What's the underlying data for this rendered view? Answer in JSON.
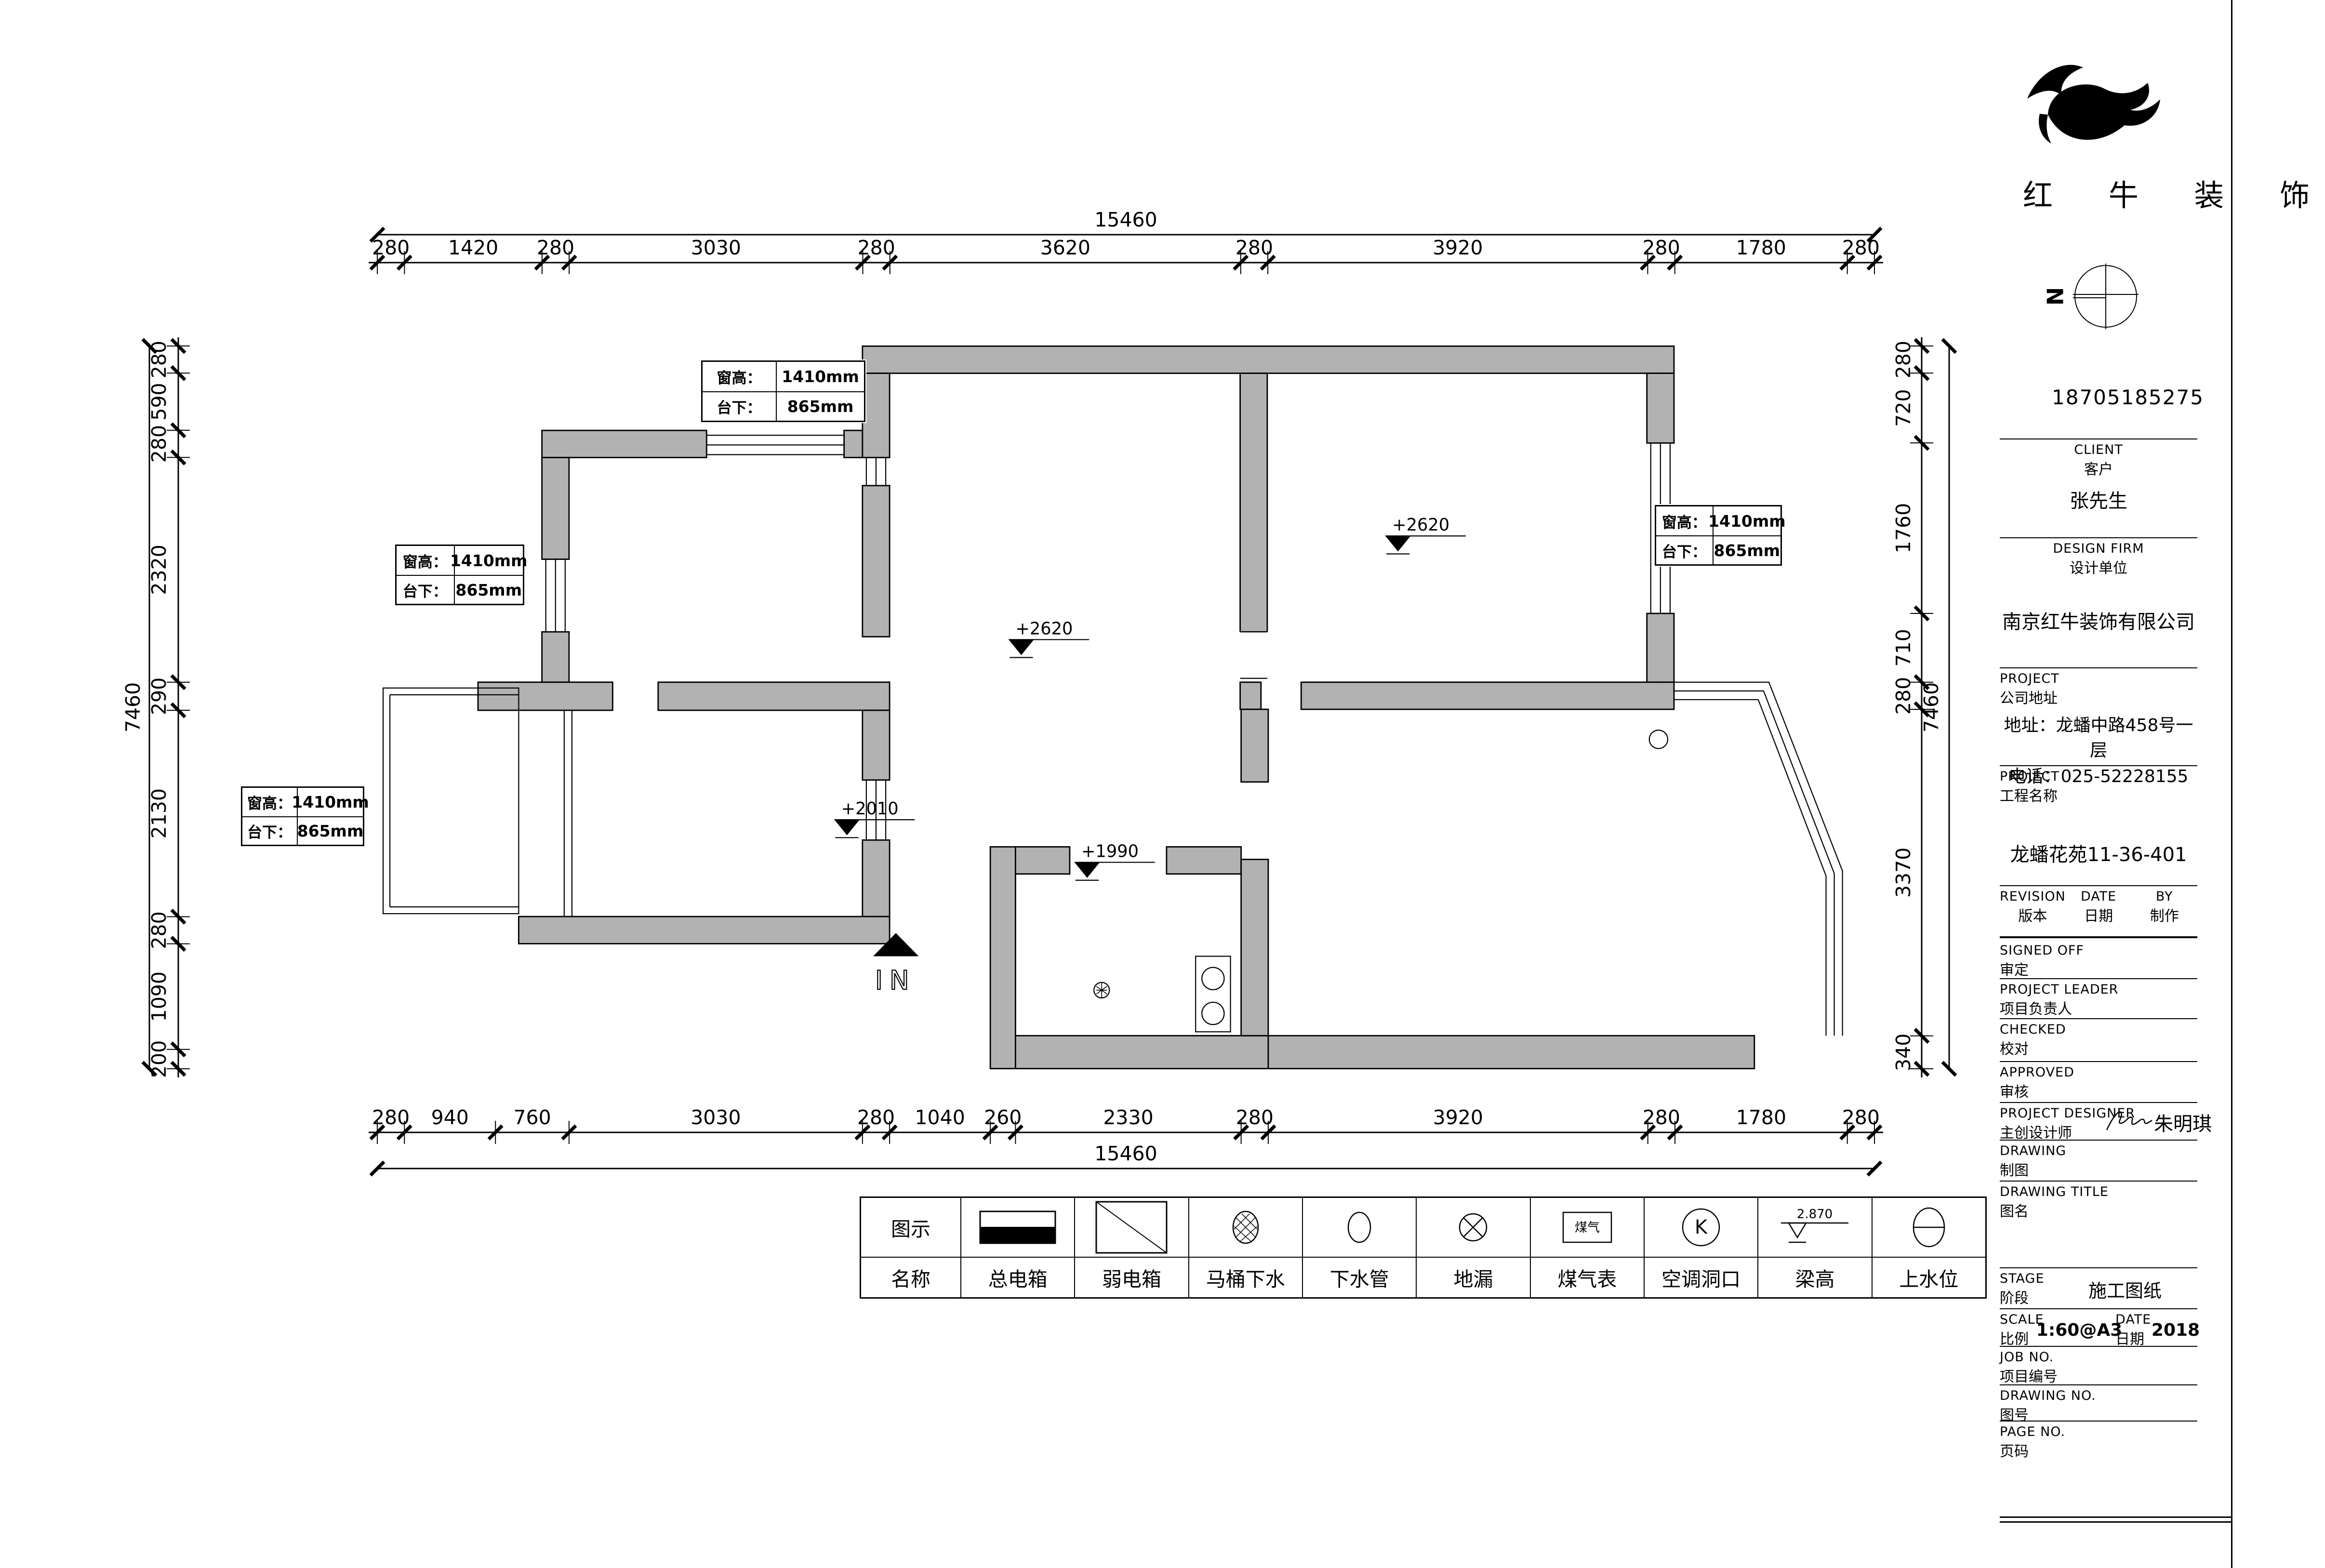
{
  "company": {
    "name": "红 牛 装 饰",
    "phone": "18705185275"
  },
  "north": {
    "label": "N"
  },
  "entry": {
    "label": "IN"
  },
  "colors": {
    "wall_fill": "#b2b2b2",
    "line": "#000000"
  },
  "dimensions": {
    "top": {
      "overall": "15460",
      "segments": [
        "280",
        "1420",
        "280",
        "3030",
        "280",
        "3620",
        "280",
        "3920",
        "280",
        "1780",
        "280"
      ]
    },
    "bottom": {
      "overall": "15460",
      "segments": [
        "280",
        "940",
        "760",
        "3030",
        "280",
        "1040",
        "260",
        "2330",
        "280",
        "3920",
        "280",
        "1780",
        "280"
      ]
    },
    "left": {
      "overall": "7460",
      "segments": [
        "280",
        "590",
        "280",
        "2320",
        "290",
        "2130",
        "280",
        "1090",
        "200"
      ]
    },
    "right": {
      "overall": "7460",
      "segments": [
        "280",
        "720",
        "1760",
        "710",
        "280",
        "3370",
        "340"
      ]
    }
  },
  "window_callouts": [
    {
      "rows": [
        {
          "label": "窗高",
          "value": "1410mm"
        },
        {
          "label": "台下",
          "value": "865mm"
        }
      ]
    },
    {
      "rows": [
        {
          "label": "窗高",
          "value": "1410mm"
        },
        {
          "label": "台下",
          "value": "865mm"
        }
      ]
    },
    {
      "rows": [
        {
          "label": "窗高",
          "value": "1410mm"
        },
        {
          "label": "台下",
          "value": "865mm"
        }
      ]
    },
    {
      "rows": [
        {
          "label": "窗高",
          "value": "1410mm"
        },
        {
          "label": "台下",
          "value": "865mm"
        }
      ]
    }
  ],
  "level_marks": [
    {
      "value": "+2620"
    },
    {
      "value": "+2620"
    },
    {
      "value": "+2010"
    },
    {
      "value": "+1990"
    }
  ],
  "legend": {
    "row1_header": "图示",
    "row2_header": "名称",
    "items": [
      {
        "name": "总电箱",
        "icon": "main-electric-box"
      },
      {
        "name": "弱电箱",
        "icon": "weak-electric-box"
      },
      {
        "name": "马桶下水",
        "icon": "toilet-drain"
      },
      {
        "name": "下水管",
        "icon": "drain-pipe"
      },
      {
        "name": "地漏",
        "icon": "floor-drain"
      },
      {
        "name": "煤气表",
        "icon": "gas-meter",
        "icon_label": "煤气"
      },
      {
        "name": "空调洞口",
        "icon": "ac-hole",
        "icon_label": "K"
      },
      {
        "name": "梁高",
        "icon": "beam-height",
        "icon_label": "2.870"
      },
      {
        "name": "上水位",
        "icon": "water-supply"
      }
    ]
  },
  "title_block": {
    "client_en": "CLIENT",
    "client_cn": "客户",
    "client_value": "张先生",
    "firm_en": "DESIGN FIRM",
    "firm_cn": "设计单位",
    "firm_value": "南京红牛装饰有限公司",
    "addr_en": "PROJECT",
    "addr_cn": "公司地址",
    "addr_line1": "地址：龙蟠中路458号一层",
    "addr_line2": "电话：025-52228155",
    "proj_en": "PROJECT",
    "proj_cn": "工程名称",
    "proj_value": "龙蟠花苑11-36-401",
    "revision_en": "REVISION",
    "revision_cn": "版本",
    "date_en": "DATE",
    "date_cn": "日期",
    "by_en": "BY",
    "by_cn": "制作",
    "signed_en": "SIGNED OFF",
    "signed_cn": "审定",
    "leader_en": "PROJECT LEADER",
    "leader_cn": "项目负责人",
    "checked_en": "CHECKED",
    "checked_cn": "校对",
    "approved_en": "APPROVED",
    "approved_cn": "审核",
    "designer_en": "PROJECT DESIGNER",
    "designer_cn": "主创设计师",
    "designer_value": "朱明琪",
    "drawing_en": "DRAWING",
    "drawing_cn": "制图",
    "dtitle_en": "DRAWING TITLE",
    "dtitle_cn": "图名",
    "stage_en": "STAGE",
    "stage_cn": "阶段",
    "stage_value": "施工图纸",
    "scale_en": "SCALE",
    "scale_cn": "比例",
    "scale_value": "1:60@A3",
    "date2_en": "DATE",
    "date2_cn": "日期",
    "date_value": "2018",
    "job_en": "JOB NO.",
    "job_cn": "项目编号",
    "dno_en": "DRAWING NO.",
    "dno_cn": "图号",
    "page_en": "PAGE NO.",
    "page_cn": "页码"
  }
}
